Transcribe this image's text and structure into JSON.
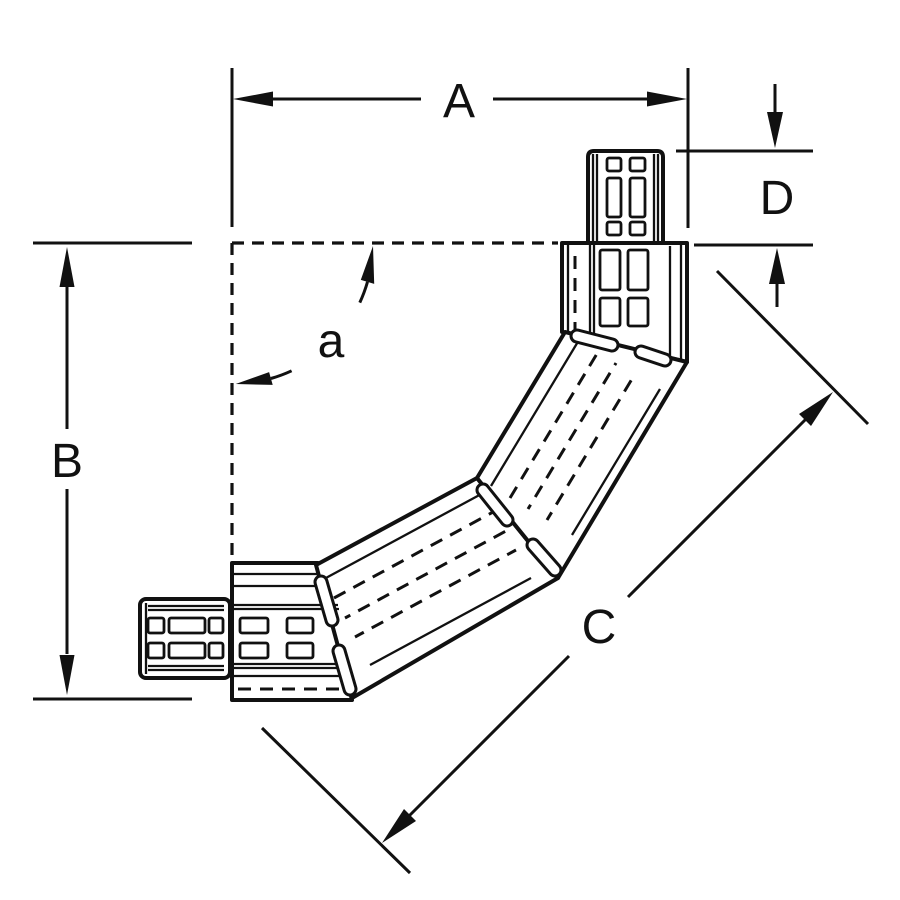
{
  "drawing": {
    "colors": {
      "ink": "#111111",
      "background": "#ffffff"
    },
    "labels": {
      "dim_a": "A",
      "dim_b": "B",
      "dim_c": "C",
      "dim_d": "D",
      "angle": "a"
    }
  }
}
